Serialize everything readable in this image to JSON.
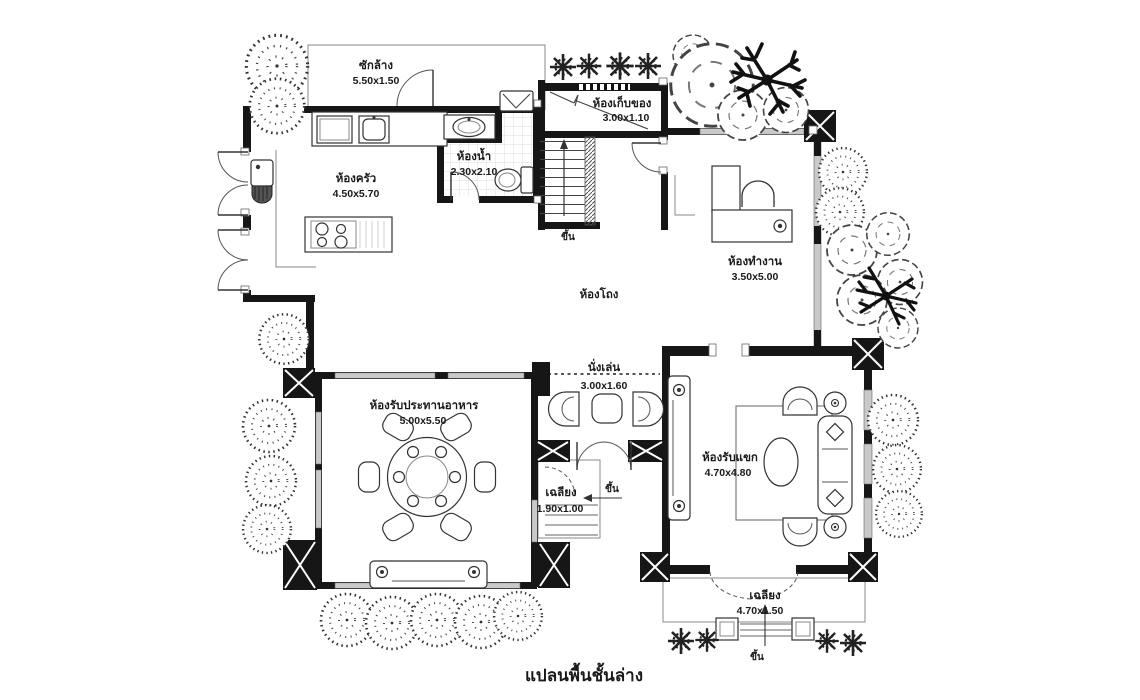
{
  "title": "แปลนพื้นชั้นล่าง",
  "labels": {
    "up": "ขึ้น"
  },
  "rooms": {
    "laundry": {
      "name": "ซักล้าง",
      "dim": "5.50x1.50"
    },
    "kitchen": {
      "name": "ห้องครัว",
      "dim": "4.50x5.70"
    },
    "bathroom": {
      "name": "ห้องน้ำ",
      "dim": "2.30x2.10"
    },
    "storage": {
      "name": "ห้องเก็บของ",
      "dim": "3.00x1.10"
    },
    "hall": {
      "name": "ห้องโถง"
    },
    "office": {
      "name": "ห้องทำงาน",
      "dim": "3.50x5.00"
    },
    "dining": {
      "name": "ห้องรับประทานอาหาร",
      "dim": "5.00x5.50"
    },
    "sitting": {
      "name": "นั่งเล่น",
      "dim": "3.00x1.60"
    },
    "porch_small": {
      "name": "เฉลียง",
      "dim": "1.90x1.00"
    },
    "living": {
      "name": "ห้องรับแขก",
      "dim": "4.70x4.80"
    },
    "porch_large": {
      "name": "เฉลียง",
      "dim": "4.70x1.50"
    }
  },
  "colors": {
    "ink": "#1a1a1a",
    "tile_grid": "#dcdcdc",
    "window_gray": "#c9c9c9"
  }
}
